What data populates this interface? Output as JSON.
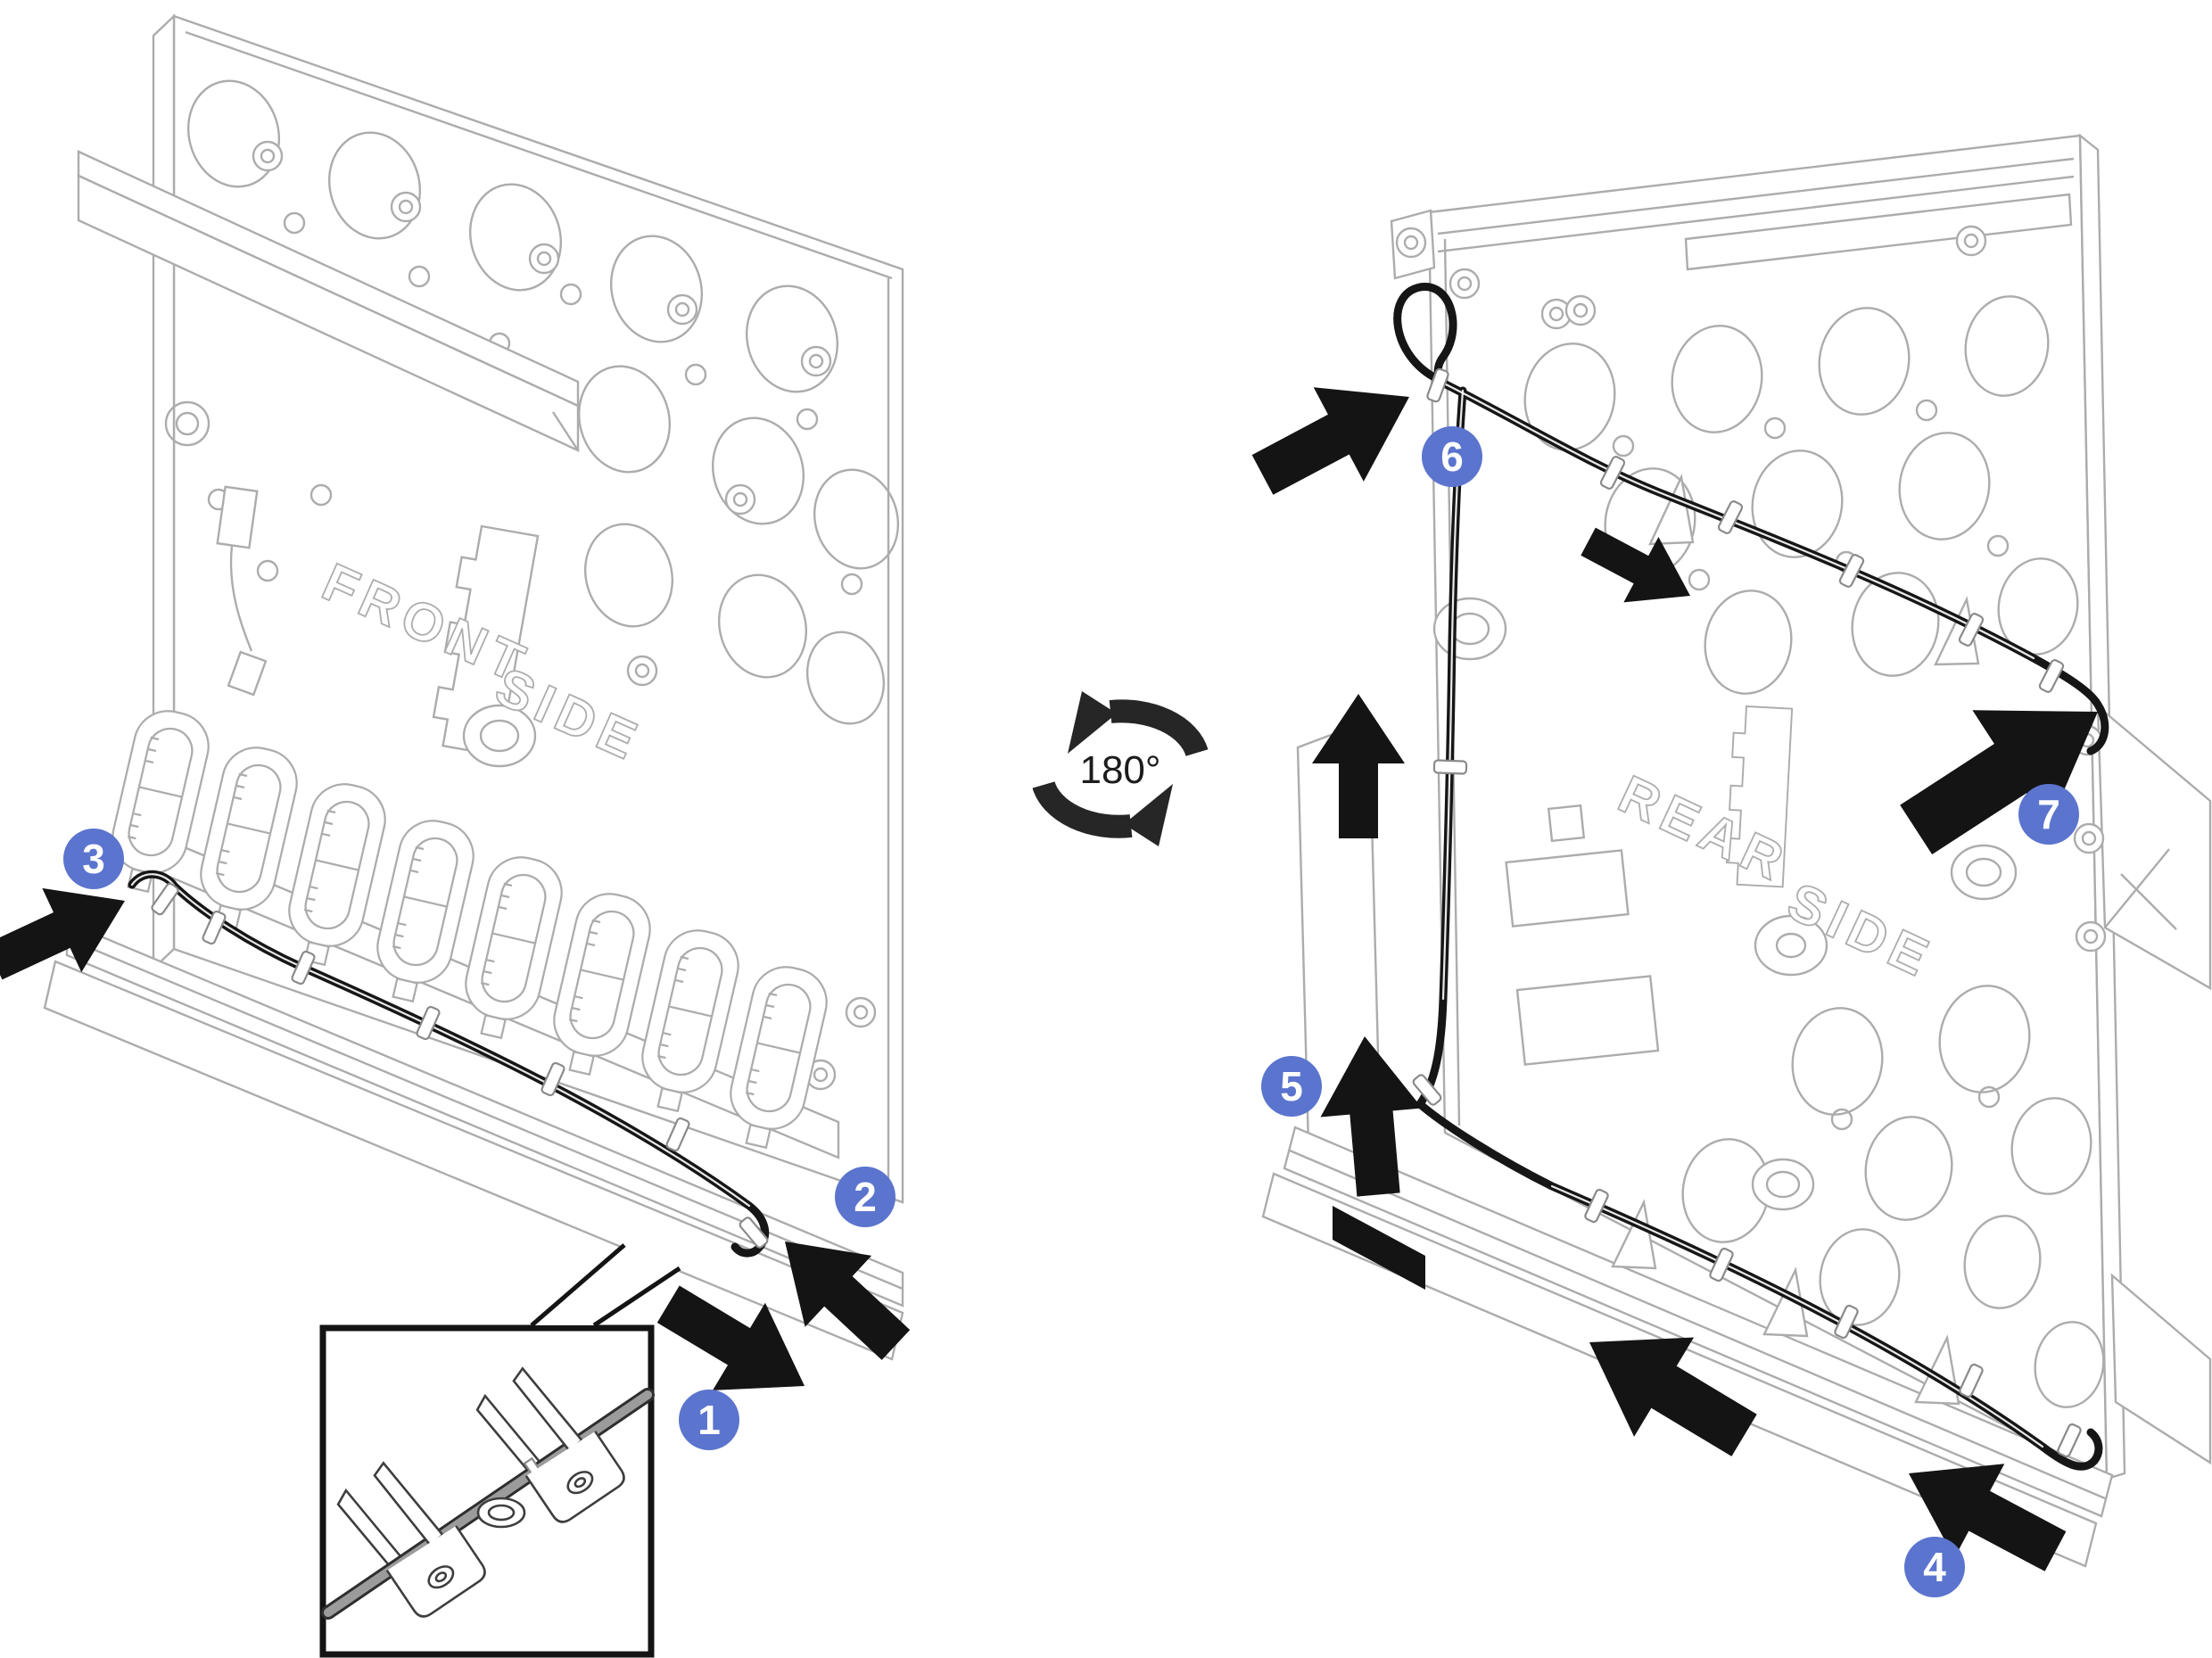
{
  "rotation_indicator": {
    "label": "180°",
    "icon": "rotate-180-arrows-icon"
  },
  "panels": {
    "front": {
      "surface_label": {
        "word1": "FRONT",
        "word2": "SIDE"
      },
      "callouts": [
        {
          "number": "1"
        },
        {
          "number": "2"
        },
        {
          "number": "3"
        }
      ]
    },
    "rear": {
      "surface_label": {
        "word1": "REAR",
        "word2": "SIDE"
      },
      "callouts": [
        {
          "number": "4"
        },
        {
          "number": "5"
        },
        {
          "number": "6"
        },
        {
          "number": "7"
        }
      ]
    }
  },
  "inset": {
    "content": "cable-retention-clips-detail"
  },
  "colors": {
    "callout_blue": "#5B74CE",
    "line_art_gray": "#ACACAC",
    "cable_black": "#161616",
    "arrow_black": "#141414",
    "inset_line_dark": "#3E3E3E",
    "background": "#FFFFFF"
  }
}
